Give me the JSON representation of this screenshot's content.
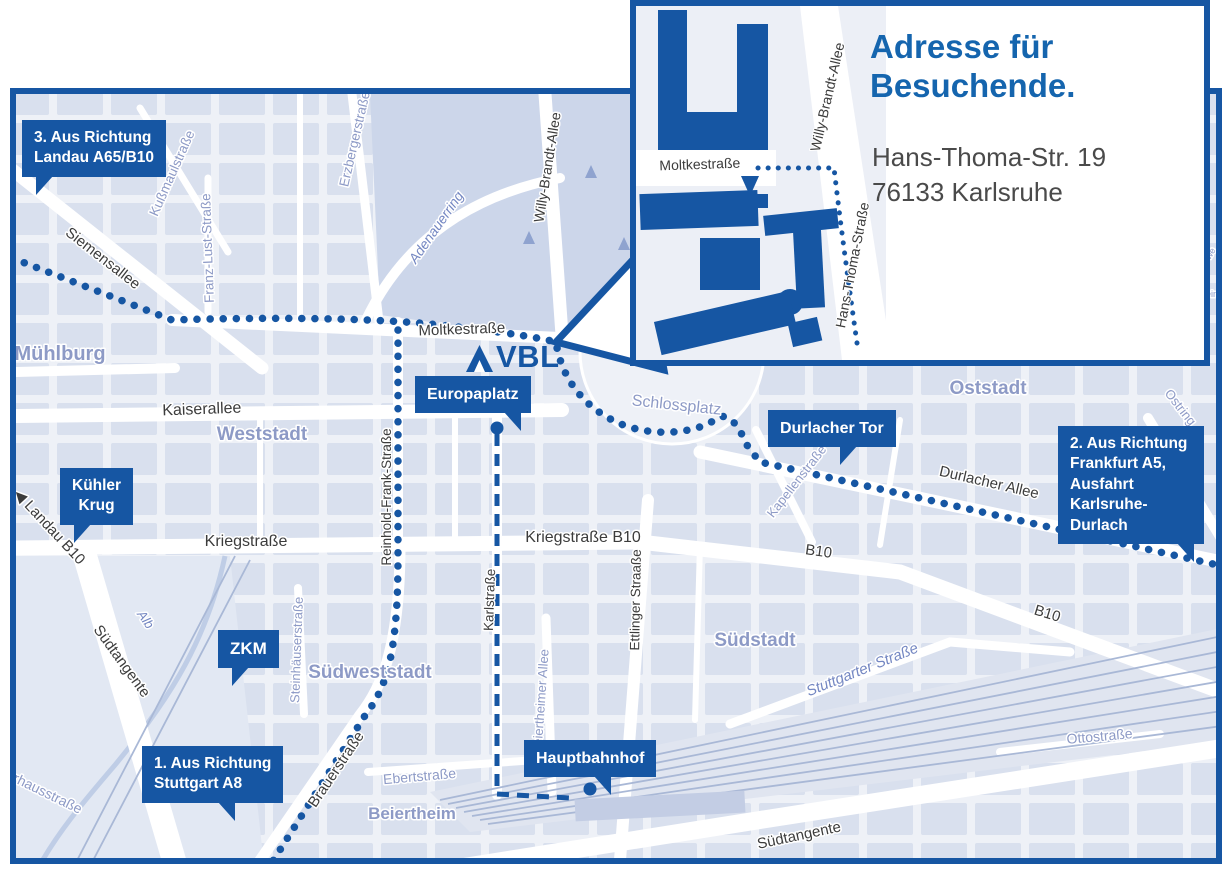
{
  "colors": {
    "brand_blue": "#1656a3",
    "title_blue": "#1565ae",
    "street_label": "#3c3c3c",
    "district_label": "#8d9ac6",
    "map_background": "#eef1f7",
    "block_fill": "#d9e0ee"
  },
  "logo": {
    "text": "VBL"
  },
  "inset": {
    "title_line1": "Adresse für",
    "title_line2": "Besuchende.",
    "address_line1": "Hans-Thoma-Str. 19",
    "address_line2": "76133 Karlsruhe",
    "labels": {
      "moltkestrasse": "Moltkestraße",
      "willy_brandt": "Willy-Brandt-Allee",
      "hans_thoma": "Hans-Thoma-Straße"
    }
  },
  "badges": {
    "b3": {
      "line1": "3. Aus Richtung",
      "line2": "Landau A65/B10"
    },
    "kuehler": {
      "line1": "Kühler",
      "line2": "Krug"
    },
    "zkm": {
      "label": "ZKM"
    },
    "b1": {
      "line1": "1. Aus Richtung",
      "line2": "Stuttgart A8"
    },
    "europaplatz": {
      "label": "Europaplatz"
    },
    "durlacher_tor": {
      "label": "Durlacher Tor"
    },
    "b2": {
      "line1": "2. Aus Richtung",
      "line2": "Frankfurt A5,",
      "line3": "Ausfahrt",
      "line4": "Karlsruhe-Durlach"
    },
    "hauptbahnhof": {
      "label": "Hauptbahnhof"
    }
  },
  "map": {
    "labels": {
      "siemensallee": {
        "text": "Siemensallee"
      },
      "kussmaulstrasse": {
        "text": "Kußmaulstraße"
      },
      "franz_lust": {
        "text": "Franz-Lust-Straße"
      },
      "erzberger": {
        "text": "Erzbergerstraße"
      },
      "muehlburg": {
        "text": "Mühlburg"
      },
      "kaiserallee": {
        "text": "Kaiserallee"
      },
      "weststadt": {
        "text": "Weststadt"
      },
      "adenauerring": {
        "text": "Adenauerring"
      },
      "willy_brandt": {
        "text": "Willy-Brandt-Allee"
      },
      "moltkestrasse": {
        "text": "Moltkestraße"
      },
      "schlossplatz": {
        "text": "Schlossplatz"
      },
      "oststadt": {
        "text": "Oststadt"
      },
      "ostring": {
        "text": "Ostring"
      },
      "durlacher_allee": {
        "text": "Durlacher Allee"
      },
      "kapellenstrasse": {
        "text": "Kapellenstraße"
      },
      "b10_a": {
        "text": "B10"
      },
      "b10_b": {
        "text": "B10"
      },
      "landau_b10": {
        "text": "◀ Landau B10"
      },
      "kriegstrasse": {
        "text": "Kriegstraße"
      },
      "kriegstrasse_b10": {
        "text": "Kriegstraße B10"
      },
      "reinhold_frank": {
        "text": "Reinhold-Frank-Straße"
      },
      "karlstrasse": {
        "text": "Karlstraße"
      },
      "ettlinger": {
        "text": "Ettlinger Straaße"
      },
      "steinhaeuser": {
        "text": "Steinhäuserstraße"
      },
      "suedweststadt": {
        "text": "Südweststadt"
      },
      "brauerstrasse": {
        "text": "Brauerstraße"
      },
      "ebertstrasse": {
        "text": "Ebertstraße"
      },
      "beiertheim": {
        "text": "Beiertheim"
      },
      "beiertheimer_allee": {
        "text": "Beiertheimer Allee"
      },
      "suedstadt": {
        "text": "Südstadt"
      },
      "stuttgarter": {
        "text": "Stuttgarter Straße"
      },
      "suedtangente_w": {
        "text": "Südtangente"
      },
      "suedtangente_s": {
        "text": "Südtangente"
      },
      "alb": {
        "text": "Alb"
      },
      "pulverhaus": {
        "text": "Pulverhausstraße"
      },
      "ottostrasse": {
        "text": "Ottostraße"
      },
      "frag_we": {
        "text": "we"
      },
      "frag_ein": {
        "text": "ein"
      }
    }
  }
}
